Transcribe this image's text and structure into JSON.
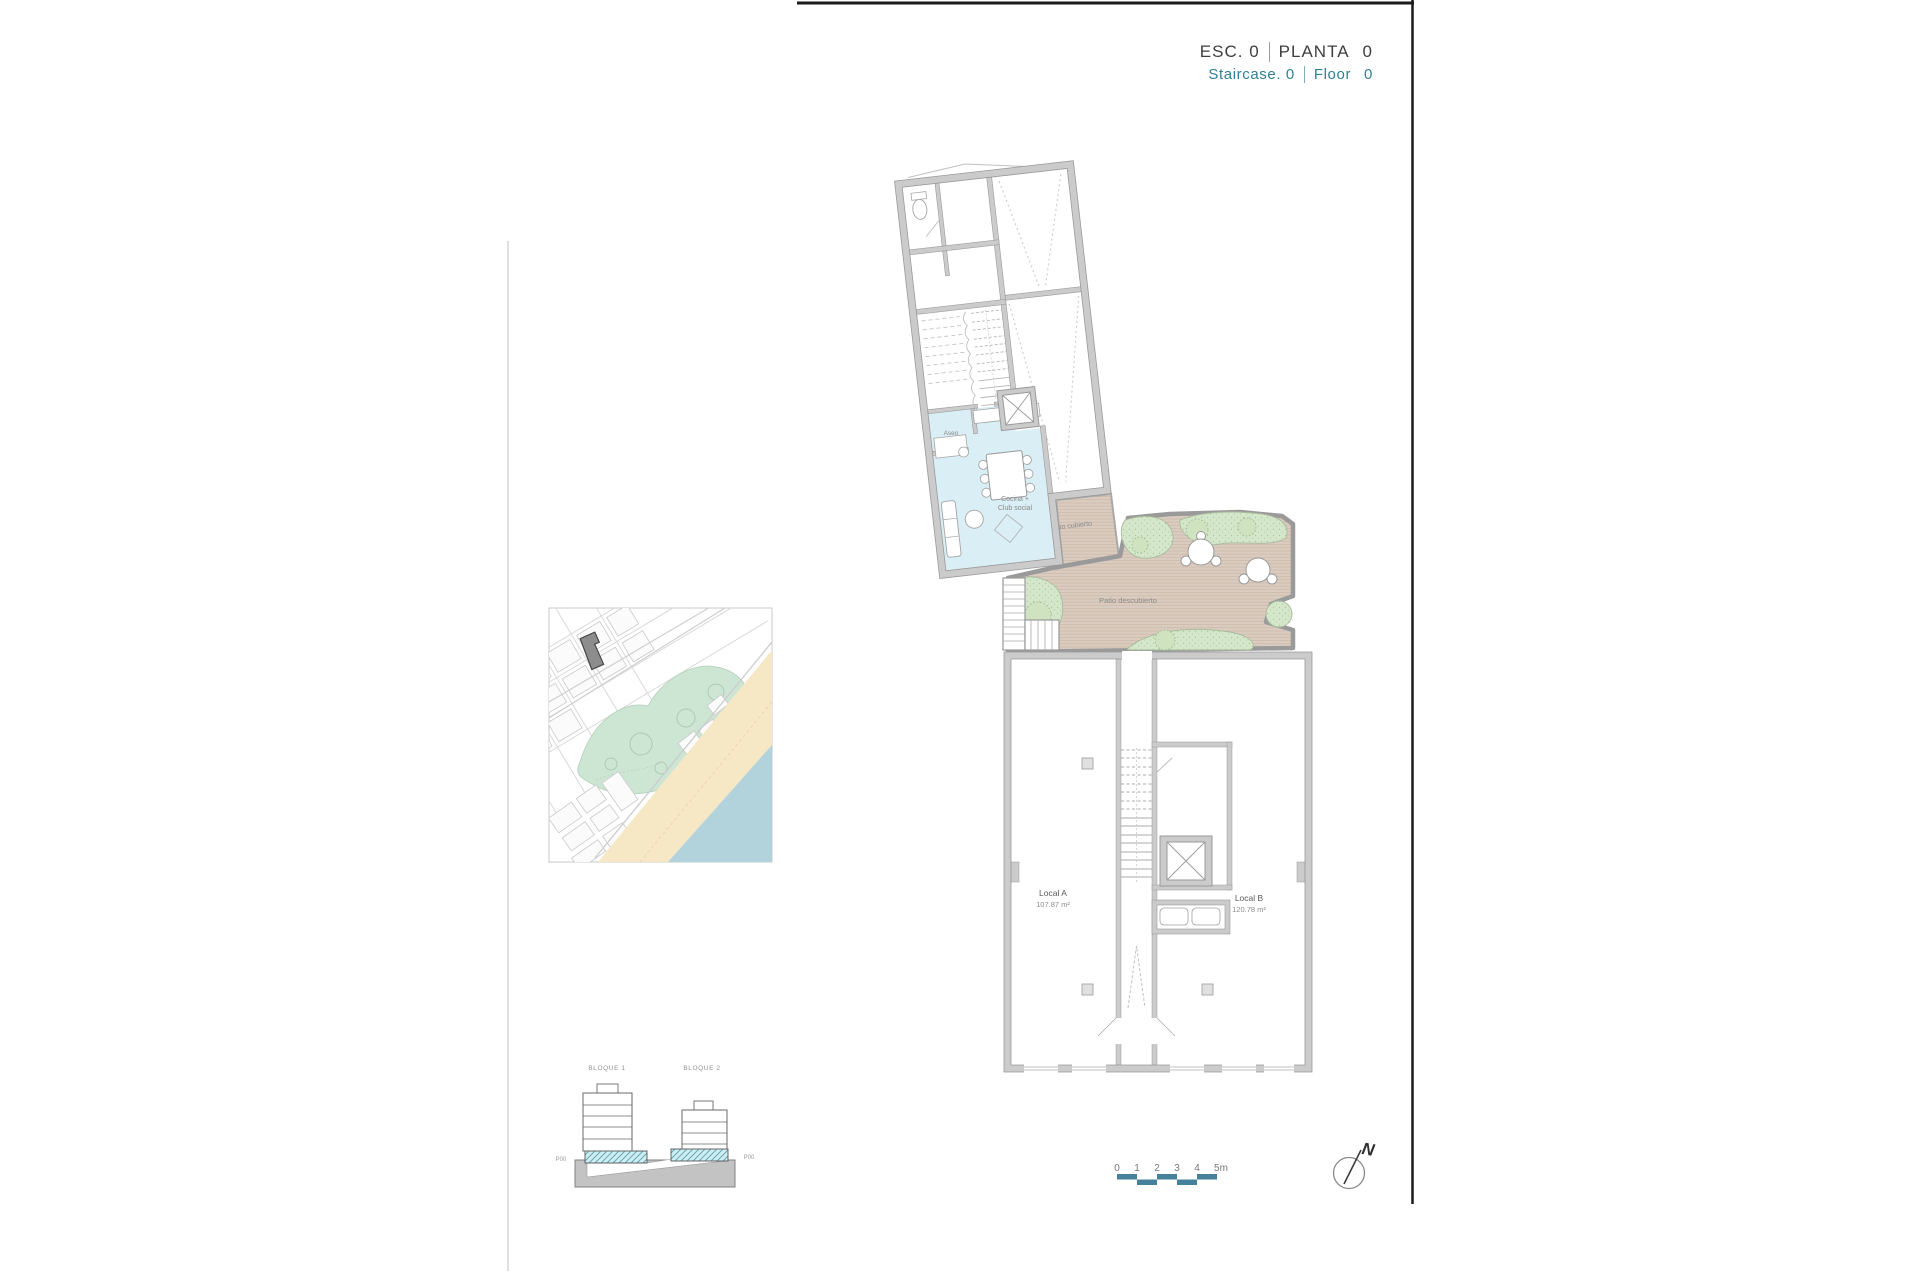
{
  "header": {
    "line_es": {
      "label1": "ESC.",
      "value1": "0",
      "label2": "PLANTA",
      "value2": "0"
    },
    "line_en": {
      "label1": "Staircase.",
      "value1": "0",
      "label2": "Floor",
      "value2": "0"
    }
  },
  "plan": {
    "labels": {
      "aseo": "Aseo",
      "cocina_line1": "Cocina +",
      "cocina_line2": "Club social",
      "patio_cubierto": "Patio cubierto",
      "patio_descubierto": "Patio descubierto"
    },
    "units": [
      {
        "name": "Local A",
        "area": "107.87 m²"
      },
      {
        "name": "Local B",
        "area": "120.78 m²"
      }
    ]
  },
  "site_section": {
    "blocks": [
      {
        "label": "BLOQUE 1"
      },
      {
        "label": "BLOQUE 2"
      }
    ],
    "level_left": "P00",
    "level_right": "P00"
  },
  "scale_bar": {
    "ticks": [
      "0",
      "1",
      "2",
      "3",
      "4",
      "5m"
    ]
  },
  "compass": {
    "north_label": "N"
  },
  "colors": {
    "accent_teal": "#2f8193",
    "scalebar_teal": "#47809b",
    "wall_gray": "#cbcbcb",
    "room_blue": "#daeef5",
    "patio_tan": "#dbccc0",
    "planting_green": "#d5e7ca",
    "map_park": "#cde6d4",
    "map_beach": "#f6e7c5",
    "map_sea": "#b3d3dc"
  }
}
